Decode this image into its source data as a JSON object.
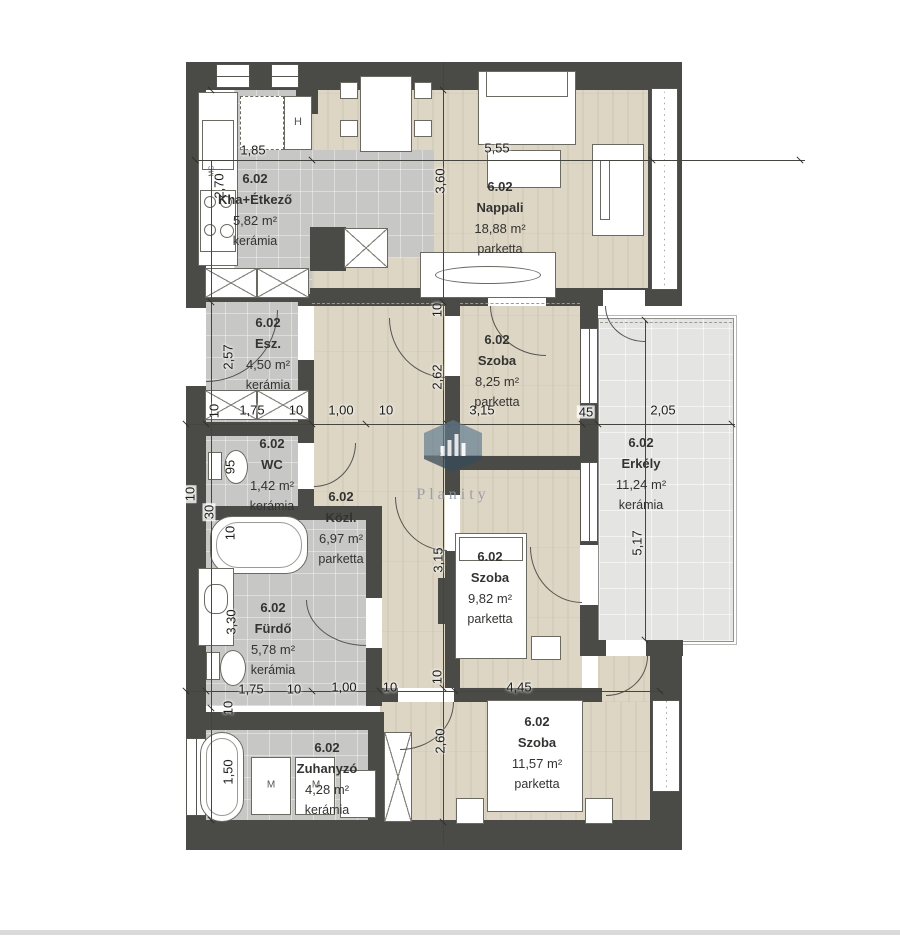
{
  "brand": {
    "watermark": "Planity"
  },
  "plan": {
    "rooms": [
      {
        "unit": "6.02",
        "name": "Kha+Étkező",
        "area": "5,82 m²",
        "floor": "kerámia"
      },
      {
        "unit": "6.02",
        "name": "Nappali",
        "area": "18,88 m²",
        "floor": "parketta"
      },
      {
        "unit": "6.02",
        "name": "Esz.",
        "area": "4,50 m²",
        "floor": "kerámia"
      },
      {
        "unit": "6.02",
        "name": "WC",
        "area": "1,42 m²",
        "floor": "kerámia"
      },
      {
        "unit": "6.02",
        "name": "Közl.",
        "area": "6,97 m²",
        "floor": "parketta"
      },
      {
        "unit": "6.02",
        "name": "Szoba",
        "area": "8,25 m²",
        "floor": "parketta"
      },
      {
        "unit": "6.02",
        "name": "Erkély",
        "area": "11,24 m²",
        "floor": "kerámia"
      },
      {
        "unit": "6.02",
        "name": "Fürdő",
        "area": "5,78 m²",
        "floor": "kerámia"
      },
      {
        "unit": "6.02",
        "name": "Szoba",
        "area": "9,82 m²",
        "floor": "parketta"
      },
      {
        "unit": "6.02",
        "name": "Zuhanyzó",
        "area": "4,28 m²",
        "floor": "kerámia"
      },
      {
        "unit": "6.02",
        "name": "Szoba",
        "area": "11,57 m²",
        "floor": "parketta"
      }
    ],
    "dims": {
      "d185": "1,85",
      "d555": "5,55",
      "d360": "3,60",
      "d270": "2,70",
      "d257": "2,57",
      "d175": "1,75",
      "d100": "1,00",
      "d10": "10",
      "d315": "3,15",
      "d262": "2,62",
      "d45": "45",
      "d205": "2,05",
      "d95": "95",
      "d30": "30",
      "d330": "3,30",
      "d517": "5,17",
      "d150": "1,50",
      "d260": "2,60",
      "d445": "4,45"
    },
    "appliances": {
      "fridge": "H",
      "washer": "M",
      "dishwasher": "MG"
    }
  },
  "colors": {
    "wall": "#4a4a46",
    "parquet": "#ddd6c5",
    "ceramic": "#c7c7c6",
    "balcony": "#e4e4e3"
  }
}
